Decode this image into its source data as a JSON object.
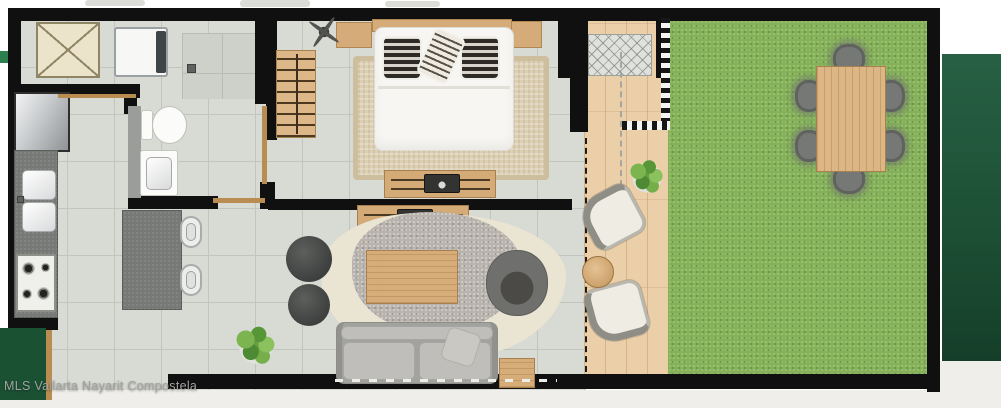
{
  "watermark": {
    "text": "MLS Vallarta Nayarit Compostela"
  },
  "palette": {
    "wall": "#101010",
    "tile_floor": "#d8dad4",
    "deck_wood": "#eacfa9",
    "grass": "#84b157",
    "dark_green_band": "#1d5035",
    "dark_green_block": "#1b5133",
    "bright_green_sliver": "#2c8050",
    "furniture_wood": "#d5ab79",
    "counter_gray": "#777976",
    "sofa_gray": "#a2a29f",
    "watermark_gray": "#a3a3a0"
  },
  "scene": {
    "elements": [
      {
        "n": "top-smudge-1",
        "t": "smudge",
        "x": 85,
        "y": 0,
        "w": 60,
        "h": 6
      },
      {
        "n": "top-smudge-2",
        "t": "smudge",
        "x": 240,
        "y": 0,
        "w": 70,
        "h": 7
      },
      {
        "n": "top-smudge-3",
        "t": "smudge",
        "x": 385,
        "y": 1,
        "w": 55,
        "h": 6
      },
      {
        "n": "right-green-band",
        "t": "greenband",
        "x": 942,
        "y": 54,
        "w": 59,
        "h": 307
      },
      {
        "n": "right-bottom-light",
        "t": "bottomstrip",
        "x": 940,
        "y": 361,
        "w": 61,
        "h": 47
      },
      {
        "n": "bottom-light-strip",
        "t": "bottomstrip",
        "x": 0,
        "y": 390,
        "w": 940,
        "h": 18
      },
      {
        "n": "left-green-sliver",
        "t": "greensliver",
        "x": 0,
        "y": 51,
        "w": 9,
        "h": 12
      },
      {
        "n": "floor-tile-main",
        "t": "tile",
        "x": 20,
        "y": 20,
        "w": 566,
        "h": 370
      },
      {
        "n": "shower-floor",
        "t": "tile2",
        "x": 182,
        "y": 33,
        "w": 76,
        "h": 66
      },
      {
        "n": "deck-floor",
        "t": "deck",
        "x": 584,
        "y": 20,
        "w": 86,
        "h": 356
      },
      {
        "n": "grass-lawn",
        "t": "grass",
        "x": 668,
        "y": 20,
        "w": 260,
        "h": 358
      },
      {
        "n": "wall-top",
        "t": "wall",
        "x": 8,
        "y": 8,
        "w": 932,
        "h": 13
      },
      {
        "n": "wall-left",
        "t": "wall",
        "x": 8,
        "y": 8,
        "w": 13,
        "h": 322
      },
      {
        "n": "wall-right",
        "t": "wall",
        "x": 927,
        "y": 8,
        "w": 13,
        "h": 384
      },
      {
        "n": "wall-bottom",
        "t": "wall",
        "x": 168,
        "y": 374,
        "w": 772,
        "h": 15
      },
      {
        "n": "wall-bottom-left",
        "t": "wall",
        "x": 8,
        "y": 316,
        "w": 50,
        "h": 14
      },
      {
        "n": "wall-closet-bottom",
        "t": "wall",
        "x": 20,
        "y": 84,
        "w": 120,
        "h": 14
      },
      {
        "n": "wall-shower-right",
        "t": "wall",
        "x": 255,
        "y": 8,
        "w": 22,
        "h": 96
      },
      {
        "n": "wall-bedroom-left",
        "t": "wall",
        "x": 266,
        "y": 96,
        "w": 11,
        "h": 44
      },
      {
        "n": "wall-bath-left",
        "t": "wall",
        "x": 124,
        "y": 84,
        "w": 13,
        "h": 30
      },
      {
        "n": "wall-bath-bottom",
        "t": "wall",
        "x": 128,
        "y": 196,
        "w": 90,
        "h": 13
      },
      {
        "n": "wall-bath-right-top",
        "t": "wall",
        "x": 256,
        "y": 84,
        "w": 18,
        "h": 20
      },
      {
        "n": "wall-bath-right-bottom",
        "t": "wall",
        "x": 260,
        "y": 182,
        "w": 15,
        "h": 27
      },
      {
        "n": "wall-bedroom-living",
        "t": "wall",
        "x": 268,
        "y": 199,
        "w": 304,
        "h": 11
      },
      {
        "n": "wall-deck-left-upper",
        "t": "wall",
        "x": 558,
        "y": 8,
        "w": 30,
        "h": 70
      },
      {
        "n": "wall-deck-left-mid",
        "t": "wall",
        "x": 570,
        "y": 78,
        "w": 18,
        "h": 54
      },
      {
        "n": "wall-deck-grass-top",
        "t": "wall",
        "x": 656,
        "y": 8,
        "w": 14,
        "h": 70
      },
      {
        "n": "tile-border-strip-vertical",
        "t": "checker-v",
        "x": 661,
        "y": 18,
        "w": 9,
        "h": 112
      },
      {
        "n": "tile-border-strip-horizontal",
        "t": "checker-h",
        "x": 622,
        "y": 121,
        "w": 48,
        "h": 9
      },
      {
        "n": "equipment-pad",
        "t": "hatch",
        "x": 588,
        "y": 34,
        "w": 64,
        "h": 42
      },
      {
        "n": "closet",
        "t": "closet",
        "x": 36,
        "y": 22,
        "w": 64,
        "h": 56
      },
      {
        "n": "washing-machine",
        "t": "washer",
        "x": 114,
        "y": 27,
        "w": 54,
        "h": 50
      },
      {
        "n": "washer-control-panel",
        "t": "darkpanel",
        "x": 156,
        "y": 31,
        "w": 10,
        "h": 42
      },
      {
        "n": "refrigerator",
        "t": "fridge",
        "x": 14,
        "y": 92,
        "w": 56,
        "h": 60
      },
      {
        "n": "kitchen-counter",
        "t": "counter",
        "x": 14,
        "y": 150,
        "w": 44,
        "h": 168
      },
      {
        "n": "sink-basin-upper",
        "t": "basin",
        "x": 22,
        "y": 170,
        "w": 34,
        "h": 30
      },
      {
        "n": "sink-basin-lower",
        "t": "basin",
        "x": 22,
        "y": 202,
        "w": 34,
        "h": 30
      },
      {
        "n": "sink-faucet",
        "t": "drain",
        "x": 17,
        "y": 196,
        "w": 7,
        "h": 7
      },
      {
        "n": "stove",
        "t": "stove",
        "x": 16,
        "y": 254,
        "w": 40,
        "h": 58
      },
      {
        "n": "stove-burner-1",
        "t": "burner",
        "x": 21,
        "y": 261,
        "w": 15,
        "h": 15
      },
      {
        "n": "stove-burner-2",
        "t": "burner",
        "x": 40,
        "y": 262,
        "w": 11,
        "h": 11
      },
      {
        "n": "stove-burner-3",
        "t": "burner",
        "x": 21,
        "y": 288,
        "w": 12,
        "h": 12
      },
      {
        "n": "stove-burner-4",
        "t": "burner",
        "x": 36,
        "y": 286,
        "w": 15,
        "h": 15
      },
      {
        "n": "kitchen-island",
        "t": "counter",
        "x": 122,
        "y": 210,
        "w": 60,
        "h": 100
      },
      {
        "n": "bar-stool-1",
        "t": "stool",
        "x": 180,
        "y": 216,
        "w": 22,
        "h": 32
      },
      {
        "n": "bar-stool-2",
        "t": "stool",
        "x": 180,
        "y": 264,
        "w": 22,
        "h": 32
      },
      {
        "n": "bath-counter",
        "t": "graystrip",
        "x": 128,
        "y": 106,
        "w": 13,
        "h": 92
      },
      {
        "n": "toilet-tank",
        "t": "white-furn",
        "x": 141,
        "y": 110,
        "w": 12,
        "h": 30
      },
      {
        "n": "toilet-bowl",
        "t": "bowl",
        "x": 152,
        "y": 106,
        "w": 35,
        "h": 38
      },
      {
        "n": "bathroom-sink",
        "t": "white-furn",
        "x": 140,
        "y": 150,
        "w": 38,
        "h": 46
      },
      {
        "n": "bathroom-sink-basin",
        "t": "basin",
        "x": 146,
        "y": 157,
        "w": 26,
        "h": 33
      },
      {
        "n": "shower-drain",
        "t": "drain",
        "x": 187,
        "y": 64,
        "w": 9,
        "h": 9
      },
      {
        "n": "door-bathroom",
        "t": "doorline",
        "x": 213,
        "y": 198,
        "w": 52,
        "h": 5
      },
      {
        "n": "door-bedroom",
        "t": "doorline",
        "x": 262,
        "y": 106,
        "w": 5,
        "h": 78
      },
      {
        "n": "door-closet",
        "t": "doorline",
        "x": 58,
        "y": 94,
        "w": 78,
        "h": 4
      },
      {
        "n": "bedroom-rug",
        "t": "rug-beige",
        "x": 353,
        "y": 56,
        "w": 196,
        "h": 124
      },
      {
        "n": "nightstand-left",
        "t": "wood",
        "x": 336,
        "y": 22,
        "w": 36,
        "h": 26
      },
      {
        "n": "nightstand-right",
        "t": "wood",
        "x": 510,
        "y": 21,
        "w": 32,
        "h": 27
      },
      {
        "n": "bed-headboard",
        "t": "wood",
        "x": 372,
        "y": 19,
        "w": 140,
        "h": 13
      },
      {
        "n": "bed-mattress",
        "t": "mattress",
        "x": 374,
        "y": 27,
        "w": 140,
        "h": 124
      },
      {
        "n": "bed-fold-line",
        "t": "foldline",
        "x": 378,
        "y": 86,
        "w": 132,
        "h": 3
      },
      {
        "n": "pillow-dark-left",
        "t": "pillow-dark",
        "x": 382,
        "y": 36,
        "w": 40,
        "h": 44
      },
      {
        "n": "pillow-dark-right",
        "t": "pillow-dark",
        "x": 460,
        "y": 36,
        "w": 40,
        "h": 44
      },
      {
        "n": "pillow-striped-center",
        "t": "pillow-light",
        "x": 424,
        "y": 31,
        "w": 34,
        "h": 50,
        "r": 24
      },
      {
        "n": "ceiling-fan",
        "t": "fan",
        "x": 306,
        "y": 14,
        "w": 36,
        "h": 36,
        "r": 35
      },
      {
        "n": "slatted-bench",
        "t": "slat",
        "x": 276,
        "y": 50,
        "w": 40,
        "h": 88
      },
      {
        "n": "tv-console-bedroom",
        "t": "console",
        "x": 384,
        "y": 170,
        "w": 112,
        "h": 28
      },
      {
        "n": "tv-bedroom",
        "t": "tv",
        "x": 424,
        "y": 174,
        "w": 36,
        "h": 19
      },
      {
        "n": "tv-console-living",
        "t": "console",
        "x": 357,
        "y": 205,
        "w": 112,
        "h": 28
      },
      {
        "n": "tv-living",
        "t": "tv",
        "x": 397,
        "y": 209,
        "w": 36,
        "h": 19
      },
      {
        "n": "area-rug-cream",
        "t": "rug-cream",
        "x": 322,
        "y": 213,
        "w": 244,
        "h": 146
      },
      {
        "n": "area-rug-gray",
        "t": "rug-gray",
        "x": 352,
        "y": 212,
        "w": 170,
        "h": 120
      },
      {
        "n": "coffee-table",
        "t": "wood-h",
        "x": 366,
        "y": 250,
        "w": 92,
        "h": 54
      },
      {
        "n": "armchair",
        "t": "armchair",
        "x": 486,
        "y": 250,
        "w": 62,
        "h": 66
      },
      {
        "n": "sofa",
        "t": "sofa-base",
        "x": 336,
        "y": 322,
        "w": 162,
        "h": 62
      },
      {
        "n": "sofa-back-cushion",
        "t": "cushion",
        "x": 341,
        "y": 326,
        "w": 152,
        "h": 14
      },
      {
        "n": "sofa-seat-cushion-1",
        "t": "cushion",
        "x": 343,
        "y": 342,
        "w": 72,
        "h": 38
      },
      {
        "n": "sofa-seat-cushion-2",
        "t": "cushion",
        "x": 419,
        "y": 342,
        "w": 72,
        "h": 38
      },
      {
        "n": "sofa-throw-pillow",
        "t": "cushion-light",
        "x": 444,
        "y": 330,
        "w": 34,
        "h": 34,
        "r": 18
      },
      {
        "n": "side-table",
        "t": "wood-h",
        "x": 499,
        "y": 358,
        "w": 36,
        "h": 30
      },
      {
        "n": "pouf-large",
        "t": "pouf",
        "x": 286,
        "y": 236,
        "w": 46,
        "h": 46
      },
      {
        "n": "pouf-small",
        "t": "pouf",
        "x": 288,
        "y": 284,
        "w": 42,
        "h": 42
      },
      {
        "n": "plant-living-room",
        "t": "plant",
        "x": 230,
        "y": 322,
        "w": 52,
        "h": 50
      },
      {
        "n": "sliding-door-living",
        "t": "dash-white",
        "x": 335,
        "y": 379,
        "w": 222,
        "h": 3
      },
      {
        "n": "sliding-door-deck",
        "t": "dash-v",
        "x": 585,
        "y": 138,
        "w": 3,
        "h": 234
      },
      {
        "n": "sliding-door-bedroom-deck",
        "t": "dash-v-gray",
        "x": 620,
        "y": 52,
        "w": 3,
        "h": 134
      },
      {
        "n": "plant-deck",
        "t": "plant",
        "x": 625,
        "y": 156,
        "w": 44,
        "h": 44
      },
      {
        "n": "lounge-chair-upper",
        "t": "lounge-a",
        "x": 584,
        "y": 190,
        "w": 56,
        "h": 54,
        "r": -28
      },
      {
        "n": "lounge-chair-lower",
        "t": "lounge-b",
        "x": 588,
        "y": 284,
        "w": 58,
        "h": 56,
        "r": -15
      },
      {
        "n": "deck-side-table",
        "t": "round-table",
        "x": 582,
        "y": 256,
        "w": 32,
        "h": 32
      },
      {
        "n": "garden-chair-top",
        "t": "dining-chair",
        "x": 833,
        "y": 44,
        "w": 32,
        "h": 30
      },
      {
        "n": "garden-chair-bottom",
        "t": "dining-chair",
        "x": 833,
        "y": 164,
        "w": 32,
        "h": 30
      },
      {
        "n": "garden-chair-left-1",
        "t": "dining-chair",
        "x": 795,
        "y": 80,
        "w": 28,
        "h": 32
      },
      {
        "n": "garden-chair-left-2",
        "t": "dining-chair",
        "x": 795,
        "y": 130,
        "w": 28,
        "h": 32
      },
      {
        "n": "garden-chair-right-1",
        "t": "dining-chair",
        "x": 877,
        "y": 80,
        "w": 28,
        "h": 32
      },
      {
        "n": "garden-chair-right-2",
        "t": "dining-chair",
        "x": 877,
        "y": 130,
        "w": 28,
        "h": 32
      },
      {
        "n": "garden-dining-table",
        "t": "wood-v",
        "x": 816,
        "y": 66,
        "w": 70,
        "h": 106
      },
      {
        "n": "left-green-block",
        "t": "greenblock",
        "x": 0,
        "y": 328,
        "w": 46,
        "h": 72
      },
      {
        "n": "left-green-block-edge",
        "t": "doorline",
        "x": 46,
        "y": 330,
        "w": 6,
        "h": 70
      }
    ]
  }
}
